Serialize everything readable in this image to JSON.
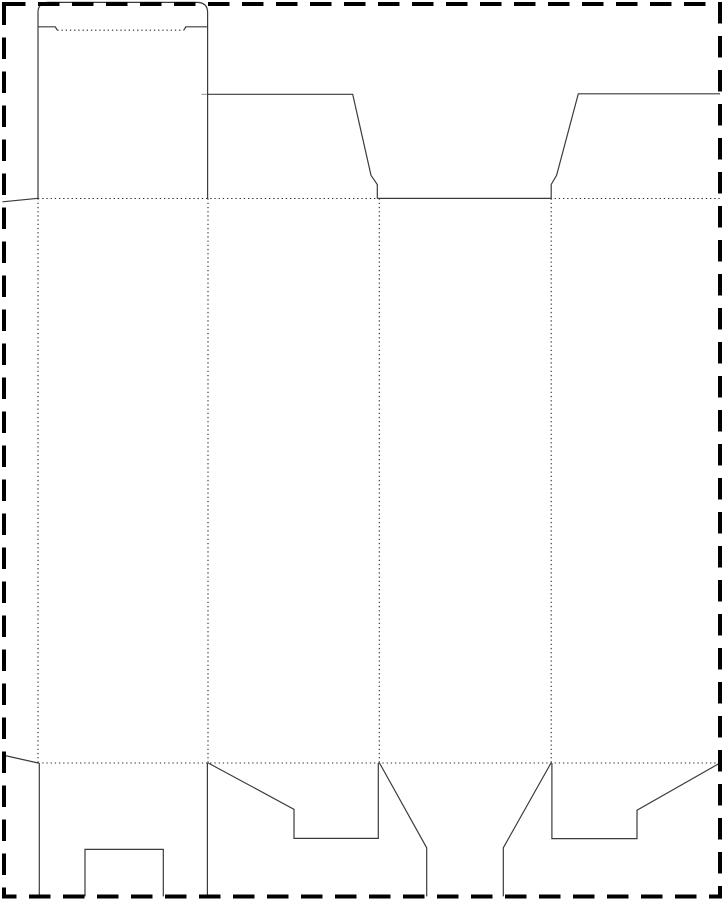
{
  "meta": {
    "description": "Folding carton die-cut template (dieline) print page, clipped by dashed page trim border. Solid lines are cut lines, dotted lines are fold/crease lines. No text content is visible.",
    "canvas_width": 724,
    "canvas_height": 900,
    "background_color": "#ffffff"
  },
  "styles": {
    "cut_line": {
      "stroke": "#3b3b3b",
      "width": 1.2,
      "dash": ""
    },
    "fold_line": {
      "stroke": "#2a2a2a",
      "width": 1.1,
      "dash": "1.3 2.9"
    },
    "nick_line": {
      "stroke": "#909090",
      "width": 1.0,
      "dash": ""
    },
    "page_border": {
      "stroke": "#000000",
      "width": 4,
      "dash": "21.5 12.5"
    }
  },
  "page_border": {
    "x": 4,
    "y": 4,
    "width": 716,
    "height": 892.5
  },
  "fold_lines": [
    {
      "name": "fold-line-top-horizontal",
      "d": "M 38 198.5 H 720"
    },
    {
      "name": "fold-line-bottom-horizontal",
      "d": "M 38 763 H 720"
    },
    {
      "name": "fold-line-glue-flap-vertical",
      "d": "M 38 198.5 V 763"
    },
    {
      "name": "fold-line-panel1-panel2-vertical",
      "d": "M 208 198.5 V 763"
    },
    {
      "name": "fold-line-panel2-panel3-vertical",
      "d": "M 379.3 198.5 V 763"
    },
    {
      "name": "fold-line-panel3-panel4-vertical",
      "d": "M 551.2 198.5 V 763"
    },
    {
      "name": "fold-line-tuck-flap",
      "d": "M 57.3 30.2 H 183.8"
    }
  ],
  "cut_lines": [
    {
      "name": "cut-tuck-flap-outline",
      "d": "M 38 198.5 V 12.5 Q 38 2.4 48.3 2.4 H 196.7 Q 207.6 2.4 207.6 12.5 V 198.5"
    },
    {
      "name": "cut-tuck-flap-left-shoulder",
      "d": "M 38 26.8 H 55.3 L 57.3 30.2"
    },
    {
      "name": "cut-tuck-flap-right-shoulder",
      "d": "M 207.6 26.8 H 185.8 L 183.8 30.2"
    },
    {
      "name": "cut-left-dust-flap-outline",
      "d": "M 208 94.3 H 352.7 L 371 175.3 L 377.3 184.5 V 198.4"
    },
    {
      "name": "cut-middle-panel-top-edge",
      "d": "M 377.3 198.4 H 551.2"
    },
    {
      "name": "cut-right-dust-flap-outline",
      "d": "M 551.2 198.4 V 184.5 L 556.6 175.3 L 578.3 93.8 H 720"
    },
    {
      "name": "cut-glue-flap-top-edge",
      "d": "M 2.5 201.8 L 38 198.3"
    },
    {
      "name": "cut-glue-flap-bottom-edge",
      "d": "M 2.5 755 L 38 763"
    },
    {
      "name": "cut-bottom-flap1-left-edge",
      "d": "M 39.3 763 V 896.4"
    },
    {
      "name": "cut-bottom-flap1-right-edge",
      "d": "M 207.4 763 V 896.4"
    },
    {
      "name": "cut-bottom-flap1-lock-notch",
      "d": "M 85 896.4 V 849.4 H 163.3 V 896.4"
    },
    {
      "name": "cut-bottom-flap2-outline",
      "d": "M 208.2 763 L 294 809.3 V 838.4 H 378.3 V 763"
    },
    {
      "name": "cut-bottom-flap3-left-edge",
      "d": "M 379.5 763 L 426.7 847.8 V 896.4"
    },
    {
      "name": "cut-bottom-flap3-right-edge",
      "d": "M 551 763 L 503.3 847.8 V 896.4"
    },
    {
      "name": "cut-bottom-flap4-outline",
      "d": "M 551.9 763 V 838.6 H 637 V 810.2 L 720 763"
    }
  ],
  "nick_lines": [
    {
      "name": "nick-dust-flap-fold",
      "d": "M 201.5 94.3 H 208"
    }
  ]
}
